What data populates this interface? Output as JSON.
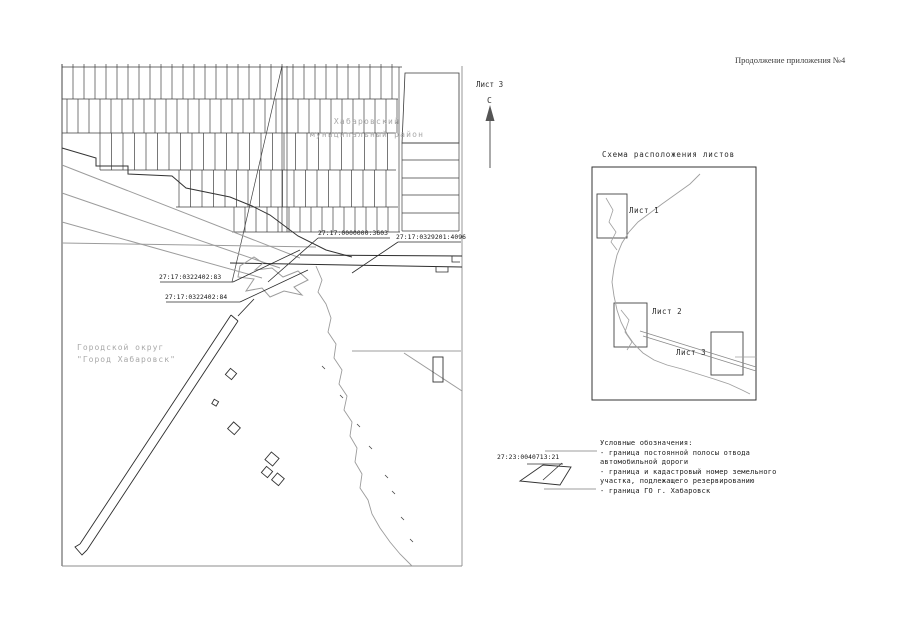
{
  "header": {
    "title": "Продолжение приложения №4"
  },
  "map": {
    "sheet_label": "Лист 3",
    "north_label": "С",
    "district_label_line1": "Хабаровский",
    "district_label_line2": "муниципальный район",
    "city_label_line1": "Городской округ",
    "city_label_line2": "\"Город Хабаровск\"",
    "parcel_labels": [
      {
        "id": "3603",
        "text": "27:17:0000000:3603"
      },
      {
        "id": "4096",
        "text": "27:17:0329201:4096"
      },
      {
        "id": "83",
        "text": "27:17:0322402:83"
      },
      {
        "id": "84",
        "text": "27:17:0322402:84"
      }
    ]
  },
  "scheme": {
    "title": "Схема расположения листов",
    "sheets": [
      {
        "label": "Лист 1"
      },
      {
        "label": "Лист 2"
      },
      {
        "label": "Лист 3"
      }
    ]
  },
  "legend": {
    "title": "Условные обозначения:",
    "parcel_number": "27:23:0040713:21",
    "items": [
      {
        "text": "- граница постоянной полосы отвода автомобильной дороги"
      },
      {
        "text": "- граница и кадастровый номер земельного участка, подлежащего резервированию"
      },
      {
        "text": "- граница ГО г. Хабаровск"
      }
    ]
  },
  "colors": {
    "line": "#333333",
    "road": "#9c9c9c",
    "muted_text": "#a8a8a8"
  }
}
